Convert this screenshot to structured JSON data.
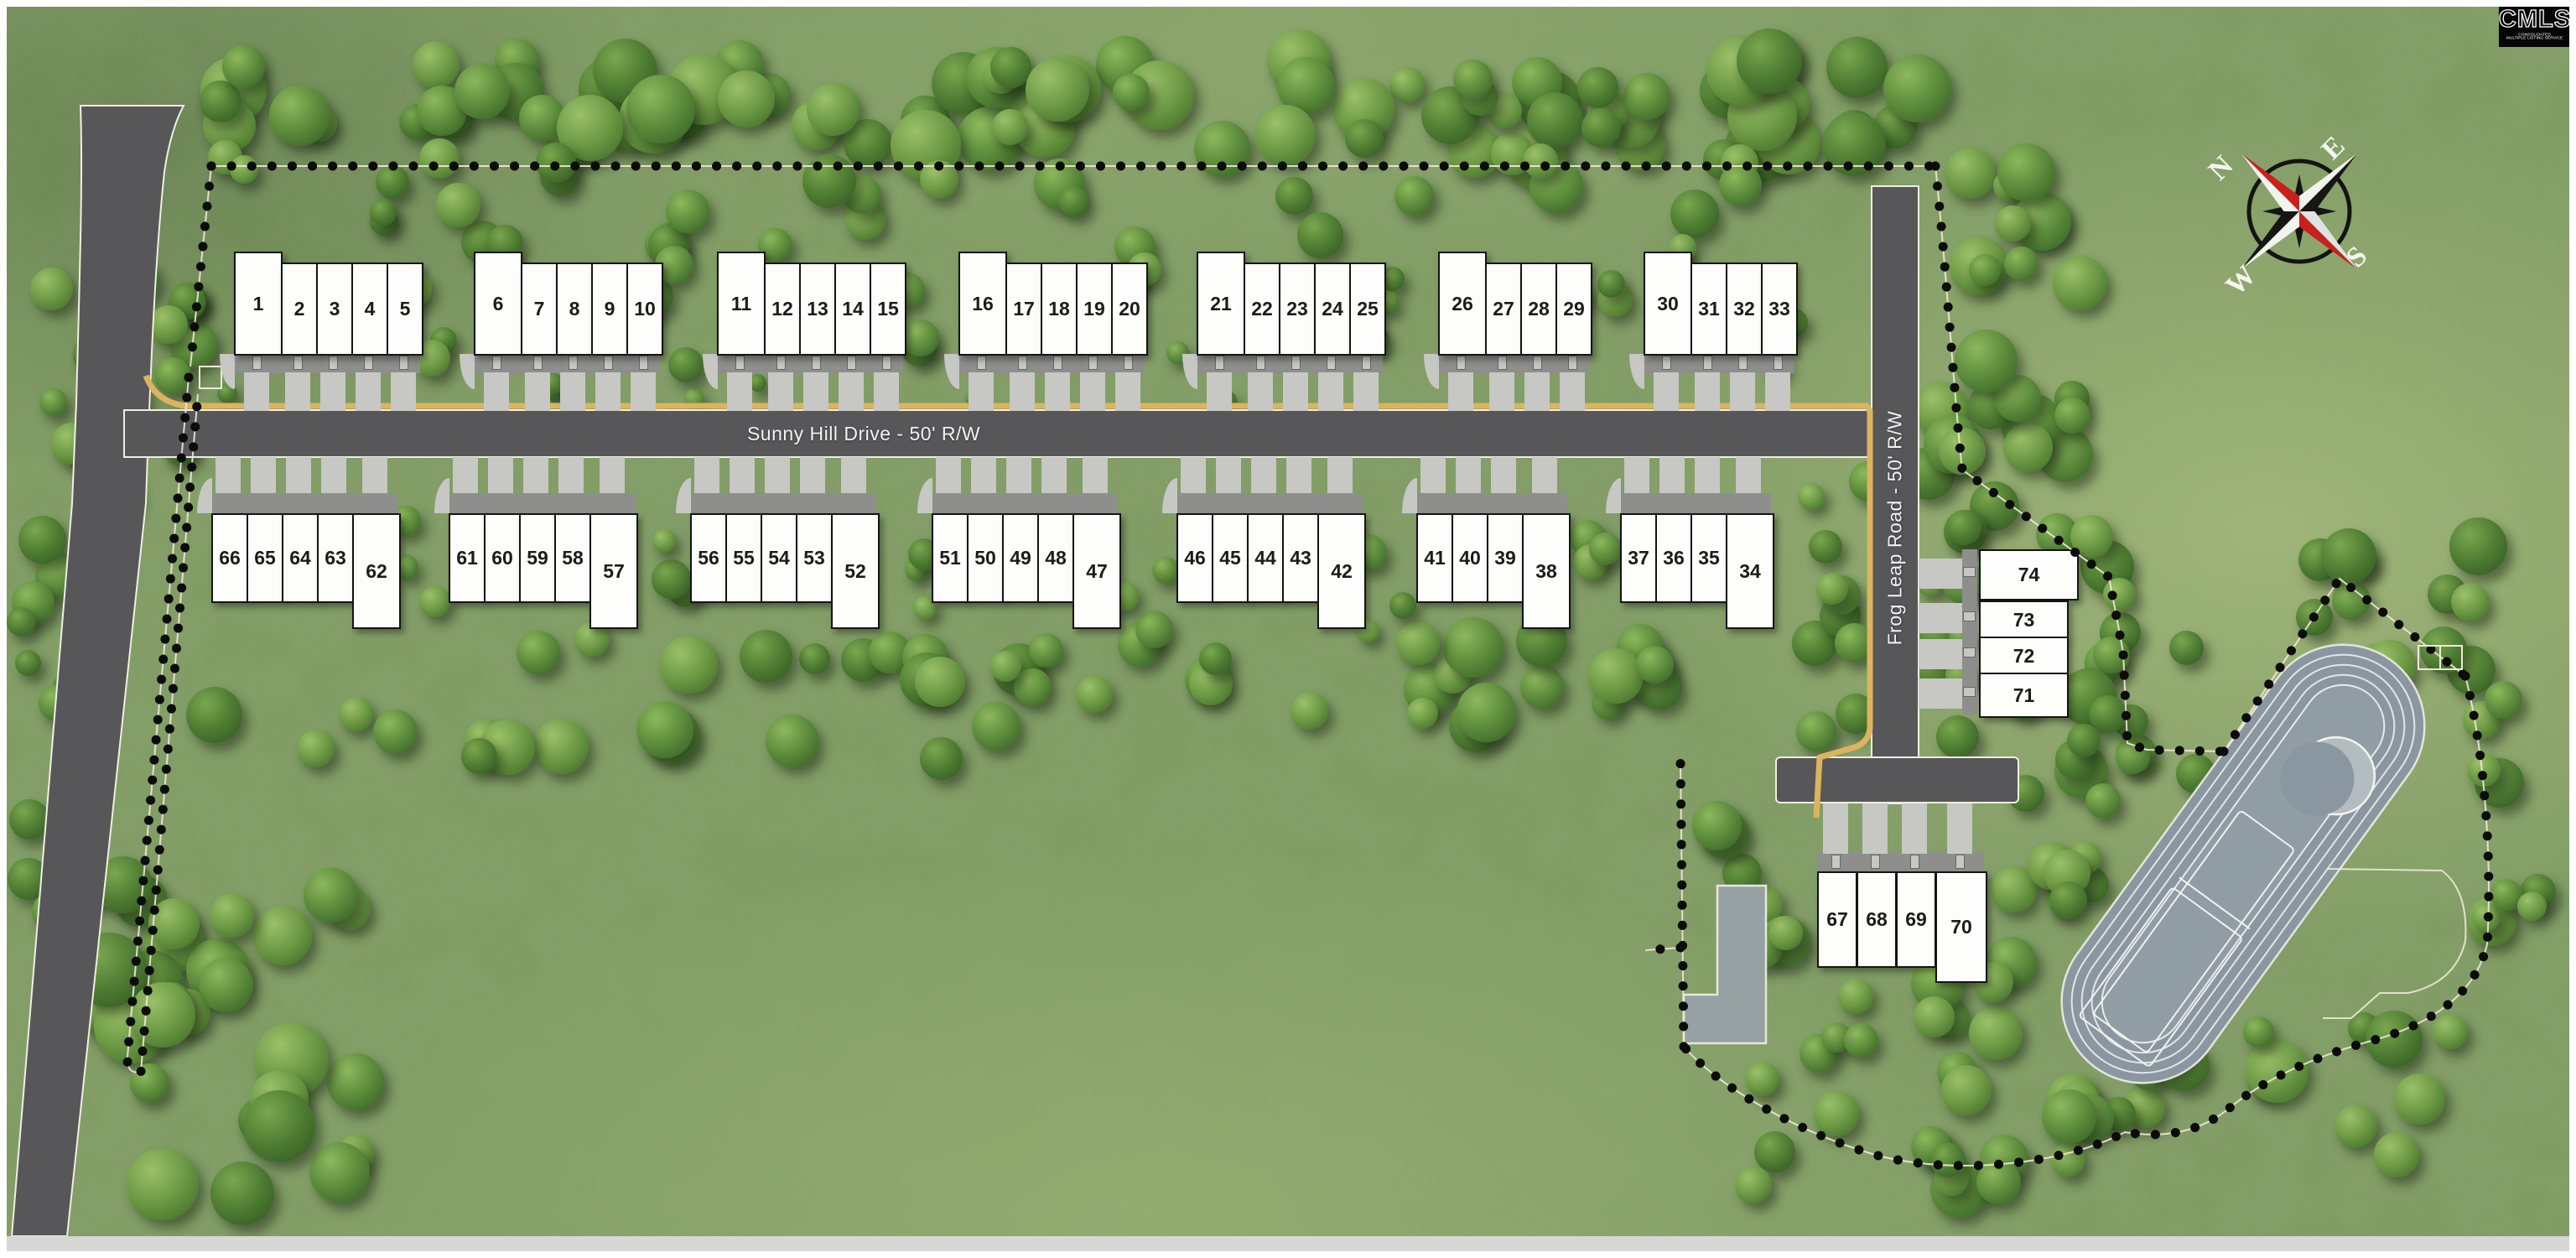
{
  "branding": {
    "logo": "CMLS",
    "logo_caption_line1": "CONSOLIDATED",
    "logo_caption_line2": "MULTIPLE LISTING SERVICE"
  },
  "roads": {
    "sunny_hill": "Sunny Hill Drive - 50' R/W",
    "frog_leap": "Frog Leap Road - 50' R/W"
  },
  "compass": {
    "north": "N",
    "east": "E",
    "south": "S",
    "west": "W"
  },
  "lots": {
    "top_row_groups": [
      [
        "1",
        "2",
        "3",
        "4",
        "5"
      ],
      [
        "6",
        "7",
        "8",
        "9",
        "10"
      ],
      [
        "11",
        "12",
        "13",
        "14",
        "15"
      ],
      [
        "16",
        "17",
        "18",
        "19",
        "20"
      ],
      [
        "21",
        "22",
        "23",
        "24",
        "25"
      ],
      [
        "26",
        "27",
        "28",
        "29"
      ],
      [
        "30",
        "31",
        "32",
        "33"
      ]
    ],
    "bottom_row_groups": [
      [
        "66",
        "65",
        "64",
        "63",
        "62"
      ],
      [
        "61",
        "60",
        "59",
        "58",
        "57"
      ],
      [
        "56",
        "55",
        "54",
        "53",
        "52"
      ],
      [
        "51",
        "50",
        "49",
        "48",
        "47"
      ],
      [
        "46",
        "45",
        "44",
        "43",
        "42"
      ],
      [
        "41",
        "40",
        "39",
        "38"
      ],
      [
        "37",
        "36",
        "35",
        "34"
      ]
    ],
    "east_column": [
      "74",
      "73",
      "72",
      "71"
    ],
    "south_cluster": [
      "67",
      "68",
      "69",
      "70"
    ]
  },
  "colors": {
    "grass": "#7e9a62",
    "road": "#57575a",
    "road_outline": "#efeee2",
    "curb": "#dcb35e",
    "driveway": "#c7c7c4",
    "apron": "#8e8e8c",
    "lot_fill": "#fdfdfc",
    "lot_border": "#141414",
    "pond": "#8a97a0",
    "pond_inner": "#909da4",
    "boundary_dot": "#0c0c0c",
    "boundary_line": "#efe9d8",
    "compass_red": "#c9201d",
    "compass_black": "#161616"
  }
}
